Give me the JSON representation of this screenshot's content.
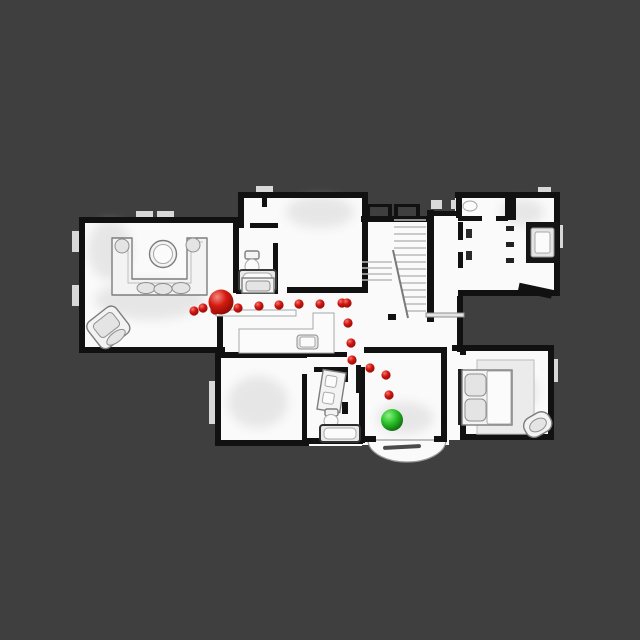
{
  "scene": {
    "type": "top-down-floorplan-navigation-view",
    "background_color": "#3f3f3f",
    "floor_color": "#fafafa",
    "wall_color": "#111111",
    "canvas": {
      "width": 640,
      "height": 640
    }
  },
  "markers": {
    "start": {
      "name": "start-marker",
      "shape": "sphere",
      "x": 221,
      "y": 302,
      "radius": 12.5,
      "highlight": "#f28a80",
      "base": "#d61a10",
      "shadow": "#7c0a06"
    },
    "goal": {
      "name": "goal-marker",
      "shape": "sphere",
      "x": 392,
      "y": 420,
      "radius": 11,
      "highlight": "#8df086",
      "base": "#2cc42a",
      "shadow": "#0b5c0a"
    },
    "waypoints": {
      "name": "path-waypoint-dots",
      "shape": "sphere",
      "radius": 4.6,
      "highlight": "#f0776e",
      "base": "#d41510",
      "shadow": "#860b06",
      "points": [
        [
          194,
          311
        ],
        [
          203,
          308
        ],
        [
          215,
          310
        ],
        [
          238,
          308
        ],
        [
          259,
          306
        ],
        [
          279,
          305
        ],
        [
          299,
          304
        ],
        [
          320,
          304
        ],
        [
          342,
          303
        ],
        [
          347,
          303
        ],
        [
          348,
          323
        ],
        [
          351,
          343
        ],
        [
          352,
          360
        ],
        [
          370,
          368
        ],
        [
          386,
          375
        ],
        [
          389,
          395
        ]
      ]
    }
  },
  "rooms": [
    {
      "name": "living-room"
    },
    {
      "name": "entry-closet"
    },
    {
      "name": "bathroom-upper"
    },
    {
      "name": "room-upper-middle"
    },
    {
      "name": "stair-hall"
    },
    {
      "name": "study-upper-right"
    },
    {
      "name": "kitchen-hall"
    },
    {
      "name": "dining-room"
    },
    {
      "name": "bathroom-lower"
    },
    {
      "name": "bedroom-lower-middle"
    },
    {
      "name": "bedroom-lower-right"
    }
  ]
}
